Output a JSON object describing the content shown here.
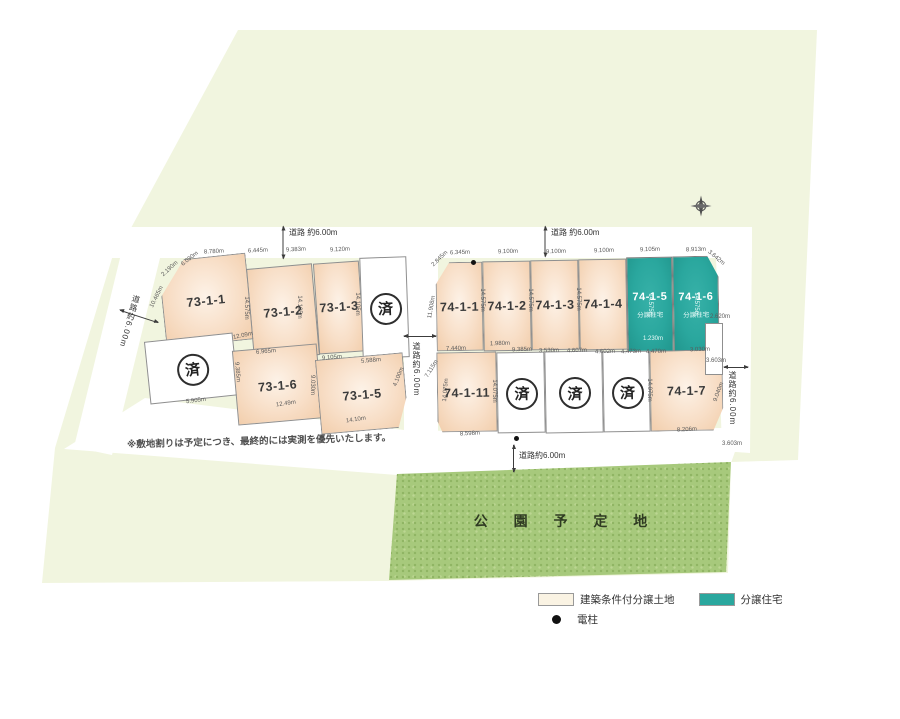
{
  "map": {
    "note": "※敷地割りは予定につき、最終的には実測を優先いたします。",
    "park_label": "公 園 予 定 地",
    "sold_char": "済"
  },
  "legend": {
    "items": [
      {
        "swatch": "cream",
        "label": "建築条件付分譲土地"
      },
      {
        "swatch": "teal",
        "label": "分譲住宅"
      },
      {
        "swatch": "dot",
        "label": "電柱"
      }
    ]
  },
  "colors": {
    "land": "#f1f5df",
    "lot_cream": "#f8dfc8",
    "lot_built_teal": "#2aa79e",
    "park_green": "#a7c97c"
  },
  "lots": [
    {
      "id": "73-1-1",
      "label": "73-1-1",
      "type": "normal",
      "x": 162,
      "y": 257,
      "w": 88,
      "h": 87,
      "rot": -6,
      "clip": "polygon(30% 0%,100% 0%,100% 100%,0% 100%,0% 40%)"
    },
    {
      "id": "73-1-2",
      "label": "73-1-2",
      "type": "normal",
      "x": 250,
      "y": 266,
      "w": 66,
      "h": 92,
      "rot": -5
    },
    {
      "id": "73-1-3",
      "label": "73-1-3",
      "type": "normal",
      "x": 316,
      "y": 262,
      "w": 46,
      "h": 91,
      "rot": -4
    },
    {
      "id": "sold-73-a",
      "label": "済",
      "type": "sold",
      "x": 361,
      "y": 257,
      "w": 47,
      "h": 101,
      "rot": -2
    },
    {
      "id": "sold-73-b",
      "label": "済",
      "type": "sold",
      "x": 147,
      "y": 337,
      "w": 89,
      "h": 63,
      "rot": -6
    },
    {
      "id": "73-1-6",
      "label": "73-1-6",
      "type": "normal",
      "x": 235,
      "y": 347,
      "w": 85,
      "h": 75,
      "rot": -5
    },
    {
      "id": "73-1-5",
      "label": "73-1-5",
      "type": "normal",
      "x": 318,
      "y": 356,
      "w": 88,
      "h": 75,
      "rot": -5,
      "clip": "polygon(0 0,100% 0,100% 60%,88% 100%,0 100%)"
    },
    {
      "id": "74-1-1",
      "label": "74-1-1",
      "type": "normal",
      "x": 436,
      "y": 262,
      "w": 47,
      "h": 89,
      "rot": -1,
      "clip": "polygon(30% 0,100% 0,100% 100%,0 100%,0 25%)"
    },
    {
      "id": "74-1-2",
      "label": "74-1-2",
      "type": "normal",
      "x": 483,
      "y": 261,
      "w": 48,
      "h": 90,
      "rot": -1
    },
    {
      "id": "74-1-3",
      "label": "74-1-3",
      "type": "normal",
      "x": 531,
      "y": 260,
      "w": 48,
      "h": 90,
      "rot": -1
    },
    {
      "id": "74-1-4",
      "label": "74-1-4",
      "type": "normal",
      "x": 579,
      "y": 259,
      "w": 48,
      "h": 91,
      "rot": -1
    },
    {
      "id": "74-1-5",
      "label": "74-1-5",
      "sub": "分譲住宅",
      "type": "built",
      "x": 627,
      "y": 257,
      "w": 46,
      "h": 95,
      "rot": -1
    },
    {
      "id": "74-1-6",
      "label": "74-1-6",
      "sub": "分譲住宅",
      "type": "built",
      "x": 673,
      "y": 256,
      "w": 46,
      "h": 96,
      "rot": -1,
      "clip": "polygon(0 0,76% 0,100% 22%,100% 100%,0 100%)"
    },
    {
      "id": "74-1-11",
      "label": "74-1-11",
      "type": "normal",
      "x": 437,
      "y": 352,
      "w": 60,
      "h": 80,
      "rot": -1,
      "clip": "polygon(0 0,100% 0,100% 100%,8% 100%,0 86%)"
    },
    {
      "id": "sold-74-a",
      "label": "済",
      "type": "sold",
      "x": 497,
      "y": 352,
      "w": 48,
      "h": 81,
      "rot": -1
    },
    {
      "id": "sold-74-b",
      "label": "済",
      "type": "sold",
      "x": 545,
      "y": 351,
      "w": 58,
      "h": 82,
      "rot": -1
    },
    {
      "id": "sold-74-c",
      "label": "済",
      "type": "sold",
      "x": 603,
      "y": 351,
      "w": 47,
      "h": 81,
      "rot": -1
    },
    {
      "id": "74-1-7",
      "label": "74-1-7",
      "type": "normal",
      "x": 650,
      "y": 350,
      "w": 73,
      "h": 81,
      "rot": -1,
      "clip": "polygon(0 0,100% 0,100% 72%,86% 100%,0 100%)"
    },
    {
      "id": "blank-right",
      "label": "",
      "type": "blank",
      "x": 705,
      "y": 323,
      "w": 18,
      "h": 52,
      "rot": 0
    }
  ],
  "roads": [
    {
      "label": "道路 約6.00m",
      "x": 289,
      "y": 227,
      "mode": "h"
    },
    {
      "label": "道路 約6.00m",
      "x": 551,
      "y": 227,
      "mode": "h"
    },
    {
      "label": "道路約6.00m",
      "x": 411,
      "y": 342,
      "mode": "v"
    },
    {
      "label": "道路約6.00m",
      "x": 727,
      "y": 371,
      "mode": "v"
    },
    {
      "label": "道路約6.00m",
      "x": 519,
      "y": 450,
      "mode": "h"
    },
    {
      "label": "道路約6.00m",
      "x": 124,
      "y": 294,
      "mode": "v",
      "rot": 16
    }
  ],
  "arrows": [
    {
      "cx": 283,
      "cy": 242,
      "len": 32,
      "rot": 90
    },
    {
      "cx": 545,
      "cy": 241,
      "len": 30,
      "rot": 90
    },
    {
      "cx": 420,
      "cy": 336,
      "len": 32,
      "rot": 0
    },
    {
      "cx": 736,
      "cy": 367,
      "len": 24,
      "rot": 0
    },
    {
      "cx": 513,
      "cy": 458,
      "len": 27,
      "rot": 90
    },
    {
      "cx": 139,
      "cy": 316,
      "len": 40,
      "rot": 18
    }
  ],
  "poles": [
    {
      "x": 473,
      "y": 262
    },
    {
      "x": 516,
      "y": 438
    }
  ],
  "dims": [
    {
      "t": "6.090m",
      "x": 190,
      "y": 259,
      "r": -38
    },
    {
      "t": "8.780m",
      "x": 214,
      "y": 252,
      "r": -3
    },
    {
      "t": "6.445m",
      "x": 258,
      "y": 251,
      "r": -3
    },
    {
      "t": "9.383m",
      "x": 296,
      "y": 250,
      "r": -3
    },
    {
      "t": "9.120m",
      "x": 340,
      "y": 250,
      "r": -3
    },
    {
      "t": "2.190m",
      "x": 170,
      "y": 269,
      "r": -42
    },
    {
      "t": "10.465m",
      "x": 157,
      "y": 297,
      "r": -64
    },
    {
      "t": "14.575m",
      "x": 246,
      "y": 308,
      "r": 90
    },
    {
      "t": "14.105m",
      "x": 299,
      "y": 307,
      "r": 90
    },
    {
      "t": "14.105m",
      "x": 357,
      "y": 304,
      "r": 90
    },
    {
      "t": "12.09m",
      "x": 243,
      "y": 336,
      "r": -12
    },
    {
      "t": "6.965m",
      "x": 266,
      "y": 352,
      "r": -5
    },
    {
      "t": "9.105m",
      "x": 332,
      "y": 358,
      "r": -5
    },
    {
      "t": "5.588m",
      "x": 371,
      "y": 361,
      "r": -5
    },
    {
      "t": "9.385m",
      "x": 237,
      "y": 372,
      "r": 85
    },
    {
      "t": "5.905m",
      "x": 196,
      "y": 401,
      "r": -7
    },
    {
      "t": "9.030m",
      "x": 312,
      "y": 385,
      "r": 90
    },
    {
      "t": "12.49m",
      "x": 286,
      "y": 404,
      "r": -9
    },
    {
      "t": "14.10m",
      "x": 356,
      "y": 420,
      "r": -9
    },
    {
      "t": "4.100m",
      "x": 399,
      "y": 377,
      "r": -68
    },
    {
      "t": "2.845m",
      "x": 440,
      "y": 259,
      "r": -44
    },
    {
      "t": "6.345m",
      "x": 460,
      "y": 253,
      "r": -2
    },
    {
      "t": "9.100m",
      "x": 508,
      "y": 252,
      "r": -2
    },
    {
      "t": "9.100m",
      "x": 556,
      "y": 252,
      "r": -2
    },
    {
      "t": "9.100m",
      "x": 604,
      "y": 251,
      "r": -2
    },
    {
      "t": "9.105m",
      "x": 650,
      "y": 250,
      "r": -2
    },
    {
      "t": "8.913m",
      "x": 696,
      "y": 250,
      "r": -2
    },
    {
      "t": "3.642m",
      "x": 716,
      "y": 258,
      "r": 40
    },
    {
      "t": "11.908m",
      "x": 432,
      "y": 307,
      "r": -80
    },
    {
      "t": "14.575m",
      "x": 482,
      "y": 300,
      "r": 90
    },
    {
      "t": "14.575m",
      "x": 530,
      "y": 300,
      "r": 90
    },
    {
      "t": "14.575m",
      "x": 578,
      "y": 299,
      "r": 90
    },
    {
      "t": "14.575m",
      "x": 650,
      "y": 305,
      "r": 90,
      "w": 1
    },
    {
      "t": "14.575m",
      "x": 696,
      "y": 304,
      "r": 90,
      "w": 1
    },
    {
      "t": "1.230m",
      "x": 653,
      "y": 339,
      "r": 0,
      "w": 1
    },
    {
      "t": "7.440m",
      "x": 456,
      "y": 349,
      "r": -2
    },
    {
      "t": "1.980m",
      "x": 500,
      "y": 344,
      "r": -2
    },
    {
      "t": "9.385m",
      "x": 522,
      "y": 350,
      "r": -2
    },
    {
      "t": "3.530m",
      "x": 549,
      "y": 351,
      "r": -2
    },
    {
      "t": "4.607m",
      "x": 577,
      "y": 351,
      "r": -2
    },
    {
      "t": "4.602m",
      "x": 605,
      "y": 352,
      "r": -2
    },
    {
      "t": "4.473m",
      "x": 631,
      "y": 352,
      "r": -2
    },
    {
      "t": "4.470m",
      "x": 656,
      "y": 352,
      "r": -2
    },
    {
      "t": "3.030m",
      "x": 700,
      "y": 350,
      "r": -2
    },
    {
      "t": "7.115m",
      "x": 432,
      "y": 369,
      "r": -58
    },
    {
      "t": "14.075m",
      "x": 446,
      "y": 390,
      "r": -85
    },
    {
      "t": "14.075m",
      "x": 494,
      "y": 391,
      "r": 90
    },
    {
      "t": "14.075m",
      "x": 649,
      "y": 390,
      "r": 90
    },
    {
      "t": "9.040m",
      "x": 719,
      "y": 392,
      "r": -70
    },
    {
      "t": "8.598m",
      "x": 470,
      "y": 434,
      "r": -3
    },
    {
      "t": "8.206m",
      "x": 687,
      "y": 430,
      "r": -3
    },
    {
      "t": "2.620m",
      "x": 720,
      "y": 317,
      "r": 0
    },
    {
      "t": "3.603m",
      "x": 716,
      "y": 361,
      "r": 0
    },
    {
      "t": "3.603m",
      "x": 732,
      "y": 444,
      "r": 0
    }
  ]
}
